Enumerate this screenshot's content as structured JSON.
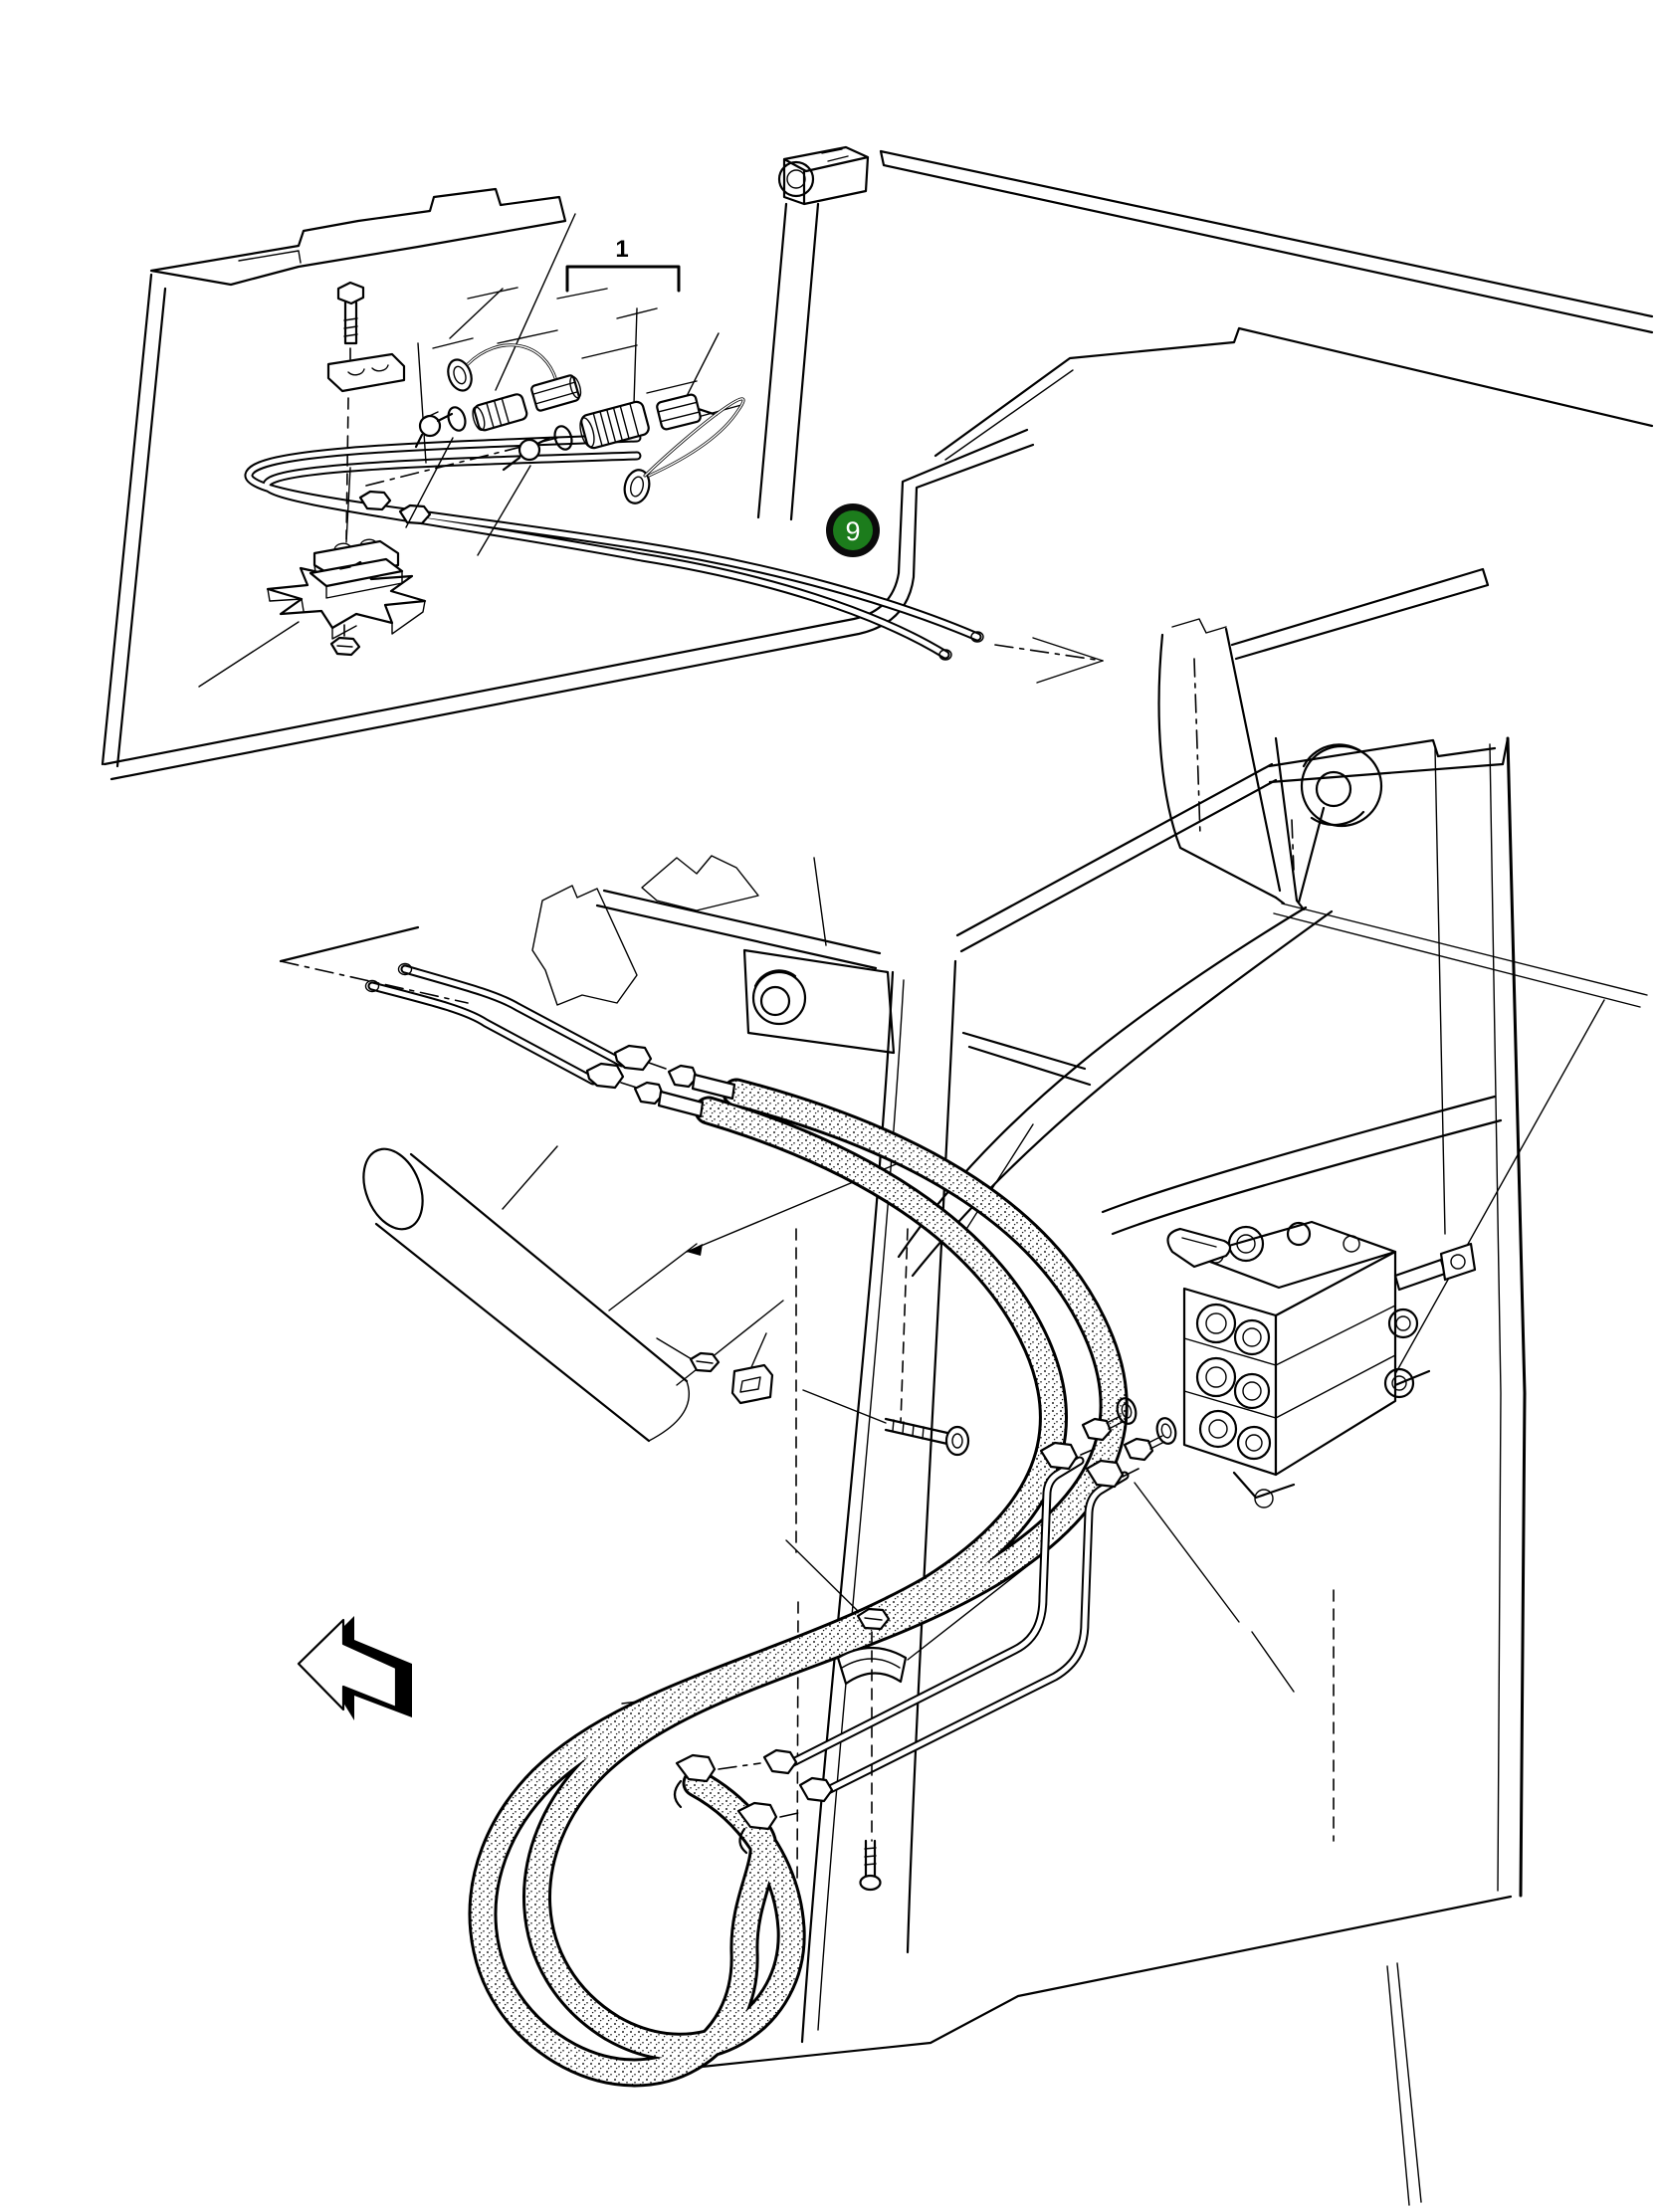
{
  "palette": {
    "background": "#ffffff",
    "ink": "#000000"
  },
  "callouts": {
    "assembly_bracket_label": "1",
    "detail_badge": {
      "label": "9",
      "fill": "#1c7c1c",
      "ring_color": "#0b0b0b",
      "label_color": "#ffffff"
    }
  },
  "arrow": {
    "name": "direction-arrow",
    "points": "left"
  }
}
